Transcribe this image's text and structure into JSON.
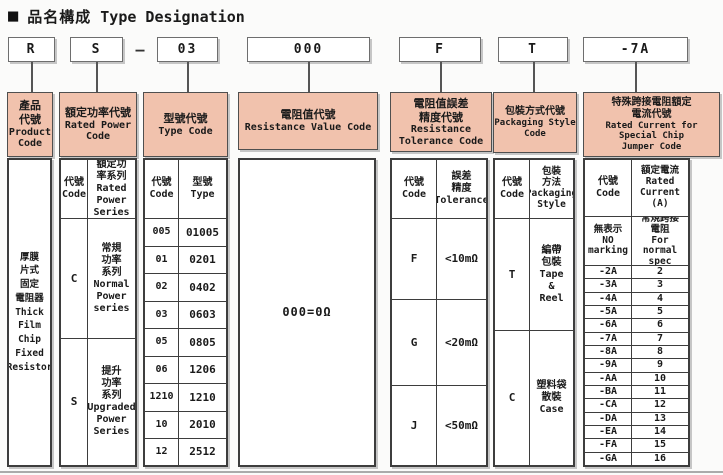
{
  "title": {
    "bullet": "■",
    "cjk": "品名構成",
    "en": "Type Designation"
  },
  "code_row": {
    "boxes": [
      "R",
      "S",
      "03",
      "000",
      "F",
      "T",
      "-7A"
    ],
    "separator": "—"
  },
  "accents": {
    "header_bg": "#f1c2ad",
    "line": "#3d3d3d"
  },
  "columns": {
    "product": {
      "header_cjk": "產品\n代號",
      "header_en": "Product\nCode",
      "body": "厚膜\n片式\n固定\n電阻器\nThick\nFilm\nChip\nFixed\nResistor"
    },
    "power": {
      "header_cjk": "額定功率代號",
      "header_en": "Rated Power\nCode",
      "sub_code": "代號\nCode",
      "sub_value": "額定功\n率系列\nRated\nPower\nSeries",
      "rows": [
        [
          "C",
          "常規\n功率\n系列\nNormal\nPower\nseries"
        ],
        [
          "S",
          "提升\n功率\n系列\nUpgraded\nPower\nSeries"
        ]
      ]
    },
    "type": {
      "header_cjk": "型號代號",
      "header_en": "Type Code",
      "sub_code": "代號\nCode",
      "sub_value": "型號\nType",
      "rows": [
        [
          "005",
          "01005"
        ],
        [
          "01",
          "0201"
        ],
        [
          "02",
          "0402"
        ],
        [
          "03",
          "0603"
        ],
        [
          "05",
          "0805"
        ],
        [
          "06",
          "1206"
        ],
        [
          "1210",
          "1210"
        ],
        [
          "10",
          "2010"
        ],
        [
          "12",
          "2512"
        ]
      ]
    },
    "resistance": {
      "header_cjk": "電阻值代號",
      "header_en": "Resistance Value Code",
      "body": "000=0Ω"
    },
    "tolerance": {
      "header_cjk": "電阻值誤差\n精度代號",
      "header_en": "Resistance\nTolerance Code",
      "sub_code": "代號\nCode",
      "sub_value": "誤差\n精度\nTolerance",
      "rows": [
        [
          "F",
          "<10mΩ"
        ],
        [
          "G",
          "<20mΩ"
        ],
        [
          "J",
          "<50mΩ"
        ]
      ]
    },
    "packaging": {
      "header_cjk": "包裝方式代號",
      "header_en": "Packaging Style\nCode",
      "sub_code": "代號\nCode",
      "sub_value": "包裝\n方法\nPackaging\nStyle",
      "rows": [
        [
          "T",
          "編帶\n包裝\nTape\n&\nReel"
        ],
        [
          "C",
          "塑料袋\n散裝\nCase"
        ]
      ]
    },
    "jumper": {
      "header_cjk": "特殊跨接電阻額定\n電流代號",
      "header_en": "Rated Current for\nSpecial Chip\nJumper Code",
      "sub_code": "代號\nCode",
      "sub_value": "額定電流\nRated\nCurrent\n(A)",
      "special_code": "無表示\nNO\nmarking",
      "special_value": "常規跨接\n電阻\nFor normal\nspec",
      "rows": [
        [
          "-2A",
          "2"
        ],
        [
          "-3A",
          "3"
        ],
        [
          "-4A",
          "4"
        ],
        [
          "-5A",
          "5"
        ],
        [
          "-6A",
          "6"
        ],
        [
          "-7A",
          "7"
        ],
        [
          "-8A",
          "8"
        ],
        [
          "-9A",
          "9"
        ],
        [
          "-AA",
          "10"
        ],
        [
          "-BA",
          "11"
        ],
        [
          "-CA",
          "12"
        ],
        [
          "-DA",
          "13"
        ],
        [
          "-EA",
          "14"
        ],
        [
          "-FA",
          "15"
        ],
        [
          "-GA",
          "16"
        ]
      ]
    }
  }
}
